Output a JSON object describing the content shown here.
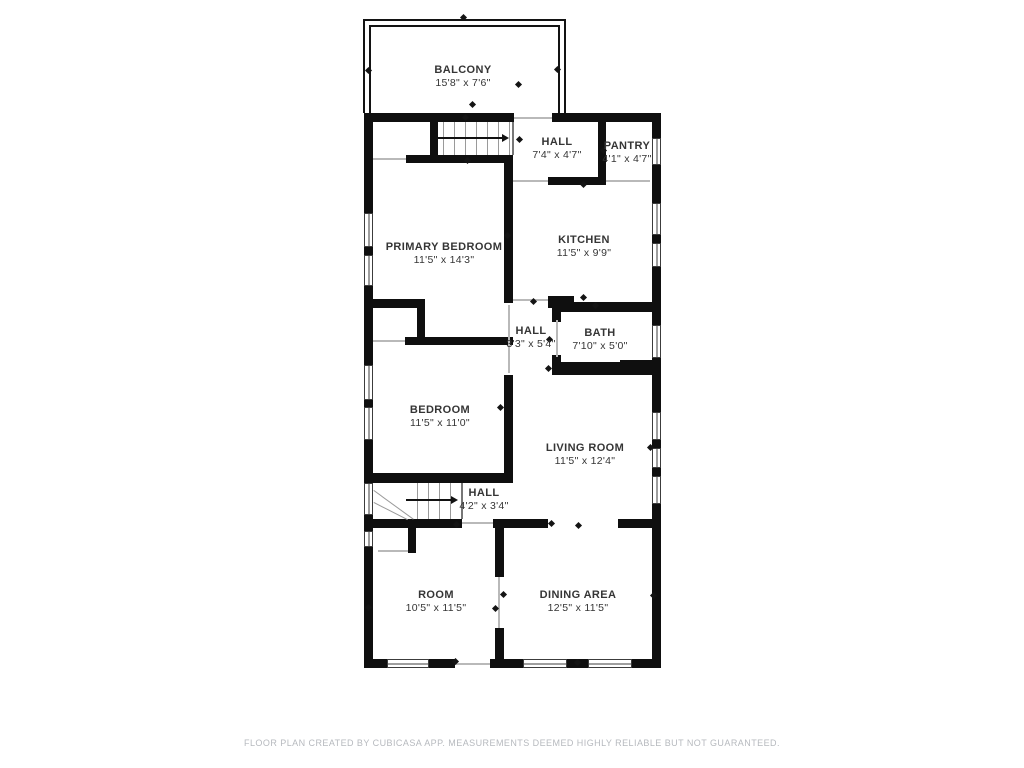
{
  "footer": {
    "text": "FLOOR PLAN CREATED BY CUBICASA APP. MEASUREMENTS DEEMED HIGHLY RELIABLE BUT NOT GUARANTEED."
  },
  "floorplan": {
    "wall_color": "#0f0f0f",
    "rooms": [
      {
        "id": "balcony",
        "name": "BALCONY",
        "dims": "15'8\" x 7'6\"",
        "cx": 463,
        "cy": 71
      },
      {
        "id": "hall-upper",
        "name": "HALL",
        "dims": "7'4\" x 4'7\"",
        "cx": 557,
        "cy": 143
      },
      {
        "id": "pantry",
        "name": "PANTRY",
        "dims": "4'1\" x 4'7\"",
        "cx": 627,
        "cy": 147
      },
      {
        "id": "primary-bedroom",
        "name": "PRIMARY BEDROOM",
        "dims": "11'5\" x 14'3\"",
        "cx": 444,
        "cy": 248
      },
      {
        "id": "kitchen",
        "name": "KITCHEN",
        "dims": "11'5\" x 9'9\"",
        "cx": 584,
        "cy": 241
      },
      {
        "id": "hall-middle",
        "name": "HALL",
        "dims": "3'3\" x 5'4\"",
        "cx": 531,
        "cy": 332
      },
      {
        "id": "bath",
        "name": "BATH",
        "dims": "7'10\" x 5'0\"",
        "cx": 600,
        "cy": 334
      },
      {
        "id": "bedroom",
        "name": "BEDROOM",
        "dims": "11'5\" x 11'0\"",
        "cx": 440,
        "cy": 411
      },
      {
        "id": "living-room",
        "name": "LIVING ROOM",
        "dims": "11'5\" x 12'4\"",
        "cx": 585,
        "cy": 449
      },
      {
        "id": "hall-lower",
        "name": "HALL",
        "dims": "4'2\" x 3'4\"",
        "cx": 484,
        "cy": 494
      },
      {
        "id": "room",
        "name": "ROOM",
        "dims": "10'5\" x 11'5\"",
        "cx": 436,
        "cy": 596
      },
      {
        "id": "dining-area",
        "name": "DINING AREA",
        "dims": "12'5\" x 11'5\"",
        "cx": 578,
        "cy": 596
      }
    ],
    "walls": [
      [
        364,
        113,
        150,
        9
      ],
      [
        552,
        113,
        109,
        9
      ],
      [
        364,
        113,
        9,
        100
      ],
      [
        364,
        247,
        9,
        8
      ],
      [
        364,
        286,
        9,
        79
      ],
      [
        364,
        400,
        9,
        7
      ],
      [
        364,
        440,
        9,
        43
      ],
      [
        364,
        515,
        9,
        16
      ],
      [
        364,
        547,
        9,
        121
      ],
      [
        652,
        113,
        9,
        25
      ],
      [
        652,
        165,
        9,
        38
      ],
      [
        652,
        235,
        9,
        8
      ],
      [
        652,
        267,
        9,
        58
      ],
      [
        652,
        358,
        9,
        54
      ],
      [
        652,
        440,
        9,
        8
      ],
      [
        652,
        468,
        9,
        8
      ],
      [
        652,
        504,
        9,
        164
      ],
      [
        364,
        659,
        23,
        9
      ],
      [
        429,
        659,
        26,
        9
      ],
      [
        490,
        659,
        33,
        9
      ],
      [
        567,
        659,
        21,
        9
      ],
      [
        632,
        659,
        29,
        9
      ],
      [
        430,
        113,
        8,
        49
      ],
      [
        406,
        155,
        107,
        8
      ],
      [
        504,
        155,
        9,
        148
      ],
      [
        548,
        177,
        58,
        8
      ],
      [
        598,
        113,
        8,
        72
      ],
      [
        364,
        299,
        61,
        9
      ],
      [
        417,
        308,
        8,
        33
      ],
      [
        405,
        337,
        108,
        8
      ],
      [
        548,
        296,
        26,
        12
      ],
      [
        557,
        302,
        95,
        10
      ],
      [
        552,
        302,
        9,
        20
      ],
      [
        552,
        355,
        9,
        17
      ],
      [
        552,
        362,
        100,
        13
      ],
      [
        620,
        360,
        32,
        15
      ],
      [
        504,
        375,
        9,
        107
      ],
      [
        364,
        473,
        149,
        10
      ],
      [
        364,
        519,
        98,
        9
      ],
      [
        493,
        519,
        55,
        9
      ],
      [
        618,
        519,
        43,
        9
      ],
      [
        495,
        519,
        9,
        58
      ],
      [
        495,
        628,
        9,
        31
      ],
      [
        408,
        528,
        8,
        25
      ]
    ],
    "windows": [
      {
        "x": 364,
        "y": 213,
        "w": 9,
        "h": 34,
        "o": "v"
      },
      {
        "x": 364,
        "y": 255,
        "w": 9,
        "h": 31,
        "o": "v"
      },
      {
        "x": 364,
        "y": 365,
        "w": 9,
        "h": 35,
        "o": "v"
      },
      {
        "x": 364,
        "y": 407,
        "w": 9,
        "h": 33,
        "o": "v"
      },
      {
        "x": 364,
        "y": 483,
        "w": 9,
        "h": 32,
        "o": "v"
      },
      {
        "x": 364,
        "y": 531,
        "w": 9,
        "h": 16,
        "o": "v"
      },
      {
        "x": 652,
        "y": 138,
        "w": 9,
        "h": 27,
        "o": "v"
      },
      {
        "x": 652,
        "y": 203,
        "w": 9,
        "h": 32,
        "o": "v"
      },
      {
        "x": 652,
        "y": 243,
        "w": 9,
        "h": 24,
        "o": "v"
      },
      {
        "x": 652,
        "y": 325,
        "w": 9,
        "h": 33,
        "o": "v"
      },
      {
        "x": 652,
        "y": 412,
        "w": 9,
        "h": 28,
        "o": "v"
      },
      {
        "x": 652,
        "y": 448,
        "w": 9,
        "h": 20,
        "o": "v"
      },
      {
        "x": 652,
        "y": 476,
        "w": 9,
        "h": 28,
        "o": "v"
      },
      {
        "x": 387,
        "y": 659,
        "w": 42,
        "h": 9,
        "o": "h"
      },
      {
        "x": 523,
        "y": 659,
        "w": 44,
        "h": 9,
        "o": "h"
      },
      {
        "x": 588,
        "y": 659,
        "w": 44,
        "h": 9,
        "o": "h"
      }
    ],
    "openings": [
      [
        514,
        117,
        38,
        2
      ],
      [
        373,
        158,
        33,
        2
      ],
      [
        513,
        180,
        35,
        2
      ],
      [
        606,
        180,
        44,
        2
      ],
      [
        373,
        340,
        32,
        2
      ],
      [
        513,
        299,
        35,
        2
      ],
      [
        508,
        305,
        2,
        68
      ],
      [
        556,
        320,
        2,
        37
      ],
      [
        462,
        522,
        31,
        2
      ],
      [
        378,
        550,
        30,
        2
      ],
      [
        498,
        577,
        2,
        51
      ],
      [
        455,
        663,
        35,
        2
      ]
    ],
    "lines": [
      {
        "x": 443,
        "y": 122,
        "w": 1,
        "h": 33,
        "c": "#9a9a9a"
      },
      {
        "x": 454,
        "y": 122,
        "w": 1,
        "h": 33,
        "c": "#9a9a9a"
      },
      {
        "x": 465,
        "y": 122,
        "w": 1,
        "h": 33,
        "c": "#9a9a9a"
      },
      {
        "x": 476,
        "y": 122,
        "w": 1,
        "h": 33,
        "c": "#9a9a9a"
      },
      {
        "x": 487,
        "y": 122,
        "w": 1,
        "h": 33,
        "c": "#9a9a9a"
      },
      {
        "x": 498,
        "y": 122,
        "w": 1,
        "h": 33,
        "c": "#9a9a9a"
      },
      {
        "x": 509,
        "y": 122,
        "w": 1,
        "h": 33,
        "c": "#9a9a9a"
      },
      {
        "x": 512,
        "y": 122,
        "w": 2,
        "h": 33,
        "c": "#777777"
      },
      {
        "x": 438,
        "y": 137,
        "w": 64,
        "h": 2,
        "c": "#111111"
      },
      {
        "x": 417,
        "y": 483,
        "w": 1,
        "h": 36,
        "c": "#9a9a9a"
      },
      {
        "x": 428,
        "y": 483,
        "w": 1,
        "h": 36,
        "c": "#9a9a9a"
      },
      {
        "x": 439,
        "y": 483,
        "w": 1,
        "h": 36,
        "c": "#9a9a9a"
      },
      {
        "x": 450,
        "y": 483,
        "w": 1,
        "h": 36,
        "c": "#9a9a9a"
      },
      {
        "x": 461,
        "y": 483,
        "w": 2,
        "h": 36,
        "c": "#777777"
      },
      {
        "x": 406,
        "y": 499,
        "w": 45,
        "h": 2,
        "c": "#111111"
      }
    ],
    "diagonals": [
      {
        "x": 374,
        "y": 490,
        "len": 49,
        "deg": 36
      },
      {
        "x": 374,
        "y": 502,
        "len": 38,
        "deg": 27
      }
    ],
    "arrowheads": [
      {
        "x": 502,
        "y": 138
      },
      {
        "x": 451,
        "y": 500
      }
    ],
    "ticks": [
      [
        465,
        117
      ],
      [
        467,
        160
      ],
      [
        519,
        139
      ],
      [
        603,
        150
      ],
      [
        583,
        184
      ],
      [
        583,
        297
      ],
      [
        533,
        301
      ],
      [
        595,
        305
      ],
      [
        548,
        368
      ],
      [
        507,
        235
      ],
      [
        368,
        70
      ],
      [
        557,
        69
      ],
      [
        463,
        17
      ],
      [
        472,
        104
      ],
      [
        518,
        84
      ],
      [
        456,
        524
      ],
      [
        551,
        523
      ],
      [
        578,
        525
      ],
      [
        455,
        661
      ],
      [
        577,
        662
      ],
      [
        653,
        595
      ],
      [
        368,
        607
      ],
      [
        503,
        594
      ],
      [
        495,
        608
      ],
      [
        549,
        339
      ],
      [
        500,
        407
      ],
      [
        650,
        447
      ]
    ],
    "balcony": {
      "outer": [
        363,
        19,
        203,
        94
      ],
      "inner": [
        369,
        25,
        191,
        88
      ]
    }
  }
}
